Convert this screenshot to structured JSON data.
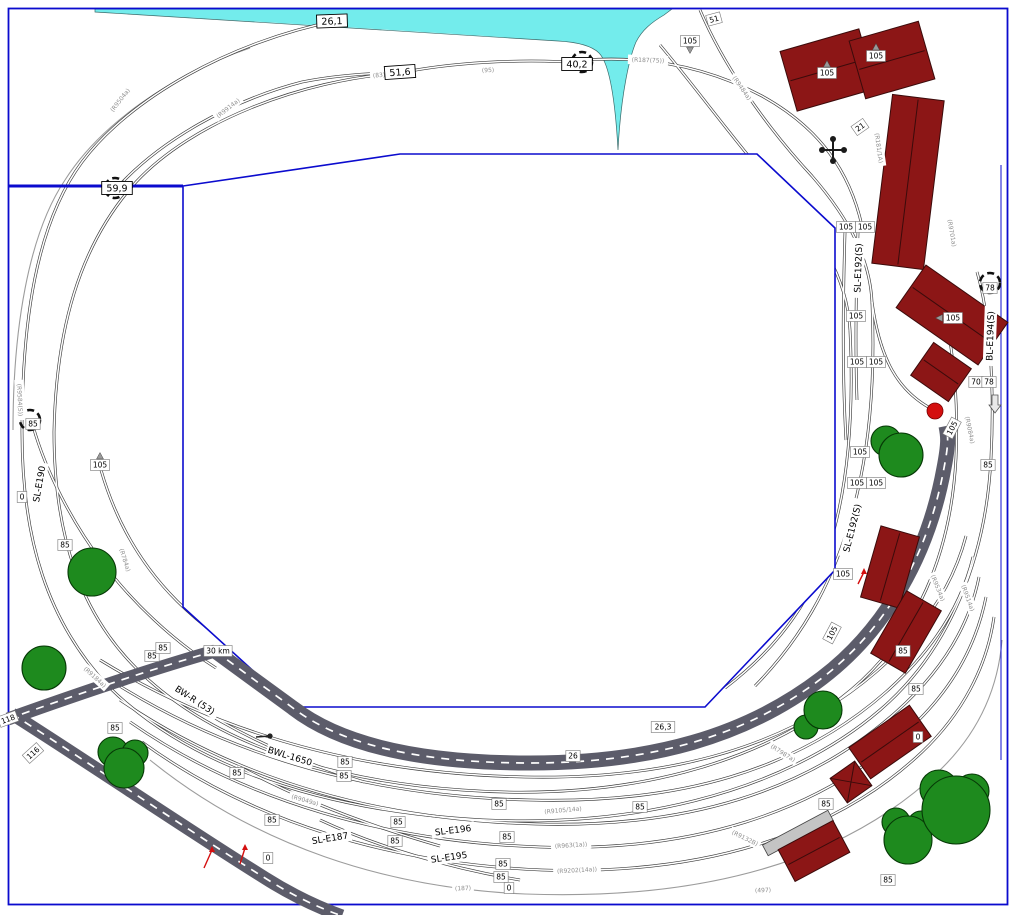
{
  "plan": {
    "colors": {
      "water": "#73ECEC",
      "boundary": "#0B0BCE",
      "building": "#8C1616",
      "building_edge": "#3B0B0B",
      "tree": "#1E8A1E",
      "tree_edge": "#063906",
      "road": "#5C5C6A",
      "road_dash": "#FFFFFF",
      "rail": "#3B3B3B",
      "rail_gap": "#FFFFFF",
      "rail_light": "#9C9C9C",
      "label_text": "#000000",
      "ref_text": "#8F8F8F",
      "signal_red": "#D40F0F",
      "platform": "#C4C4C4"
    },
    "measure_labels_large": [
      {
        "t": "26,1",
        "x": 332,
        "y": 21,
        "r": -2
      },
      {
        "t": "51,6",
        "x": 400,
        "y": 72,
        "r": -4
      },
      {
        "t": "40,2",
        "x": 577,
        "y": 64,
        "r": 0
      },
      {
        "t": "59,9",
        "x": 117,
        "y": 188,
        "r": 0
      }
    ],
    "measure_labels": [
      {
        "t": "85",
        "x": 33,
        "y": 424
      },
      {
        "t": "0",
        "x": 22,
        "y": 497
      },
      {
        "t": "105",
        "x": 100,
        "y": 465,
        "ptr": "up"
      },
      {
        "t": "85",
        "x": 65,
        "y": 545
      },
      {
        "t": "85",
        "x": 152,
        "y": 656
      },
      {
        "t": "85",
        "x": 163,
        "y": 648
      },
      {
        "t": "85",
        "x": 115,
        "y": 728
      },
      {
        "t": "118",
        "x": 8,
        "y": 719,
        "r": -20
      },
      {
        "t": "116",
        "x": 33,
        "y": 753,
        "r": -42
      },
      {
        "t": "30 km",
        "x": 218,
        "y": 651
      },
      {
        "t": "85",
        "x": 237,
        "y": 773
      },
      {
        "t": "85",
        "x": 272,
        "y": 820
      },
      {
        "t": "0",
        "x": 268,
        "y": 858
      },
      {
        "t": "85",
        "x": 345,
        "y": 762
      },
      {
        "t": "85",
        "x": 344,
        "y": 776
      },
      {
        "t": "85",
        "x": 398,
        "y": 822
      },
      {
        "t": "85",
        "x": 395,
        "y": 841
      },
      {
        "t": "85",
        "x": 499,
        "y": 804
      },
      {
        "t": "85",
        "x": 507,
        "y": 837
      },
      {
        "t": "85",
        "x": 503,
        "y": 864
      },
      {
        "t": "85",
        "x": 501,
        "y": 877
      },
      {
        "t": "0",
        "x": 509,
        "y": 888
      },
      {
        "t": "26",
        "x": 573,
        "y": 756
      },
      {
        "t": "26,3",
        "x": 663,
        "y": 727
      },
      {
        "t": "85",
        "x": 640,
        "y": 807
      },
      {
        "t": "85",
        "x": 826,
        "y": 804
      },
      {
        "t": "85",
        "x": 888,
        "y": 880
      },
      {
        "t": "85",
        "x": 903,
        "y": 651
      },
      {
        "t": "85",
        "x": 916,
        "y": 689
      },
      {
        "t": "0",
        "x": 918,
        "y": 737
      },
      {
        "t": "105",
        "x": 832,
        "y": 633,
        "r": -62
      },
      {
        "t": "105",
        "x": 843,
        "y": 574
      },
      {
        "t": "105",
        "x": 952,
        "y": 428,
        "r": -62
      },
      {
        "t": "105",
        "x": 846,
        "y": 227
      },
      {
        "t": "105",
        "x": 865,
        "y": 227
      },
      {
        "t": "105",
        "x": 856,
        "y": 316
      },
      {
        "t": "105",
        "x": 857,
        "y": 362
      },
      {
        "t": "105",
        "x": 876,
        "y": 362
      },
      {
        "t": "105",
        "x": 860,
        "y": 452
      },
      {
        "t": "105",
        "x": 857,
        "y": 483
      },
      {
        "t": "105",
        "x": 876,
        "y": 483
      },
      {
        "t": "78",
        "x": 990,
        "y": 288
      },
      {
        "t": "70",
        "x": 976,
        "y": 382
      },
      {
        "t": "78",
        "x": 989,
        "y": 382
      },
      {
        "t": "85",
        "x": 988,
        "y": 465
      },
      {
        "t": "105",
        "x": 690,
        "y": 41,
        "ptr": "down"
      },
      {
        "t": "105",
        "x": 827,
        "y": 73,
        "ptr": "up"
      },
      {
        "t": "105",
        "x": 876,
        "y": 56,
        "ptr": "up"
      },
      {
        "t": "105",
        "x": 953,
        "y": 318,
        "ptr": "left"
      },
      {
        "t": "21",
        "x": 860,
        "y": 127,
        "r": -35
      },
      {
        "t": "51",
        "x": 714,
        "y": 19,
        "r": -15
      }
    ],
    "ref_labels": [
      {
        "t": "(R9504a)",
        "x": 120,
        "y": 100,
        "r": -52
      },
      {
        "t": "(R9914a)",
        "x": 228,
        "y": 108,
        "r": -38
      },
      {
        "t": "(83)",
        "x": 379,
        "y": 75,
        "r": -4
      },
      {
        "t": "(95)",
        "x": 488,
        "y": 70,
        "r": -2
      },
      {
        "t": "(R187(75))",
        "x": 648,
        "y": 60,
        "r": 2
      },
      {
        "t": "(R9484a)",
        "x": 742,
        "y": 88,
        "r": 55
      },
      {
        "t": "(R181/1A)",
        "x": 879,
        "y": 148,
        "r": 82
      },
      {
        "t": "(R9701a)",
        "x": 952,
        "y": 233,
        "r": 80
      },
      {
        "t": "(R9534a)",
        "x": 938,
        "y": 588,
        "r": 68
      },
      {
        "t": "(R9514a)",
        "x": 968,
        "y": 598,
        "r": 70
      },
      {
        "t": "(R9084a)",
        "x": 970,
        "y": 430,
        "r": 78
      },
      {
        "t": "(R784a)",
        "x": 125,
        "y": 560,
        "r": 72
      },
      {
        "t": "(R9584(S))",
        "x": 20,
        "y": 400,
        "r": 87
      },
      {
        "t": "(R9184a)",
        "x": 95,
        "y": 677,
        "r": 42
      },
      {
        "t": "(R9049a)",
        "x": 305,
        "y": 800,
        "r": 16
      },
      {
        "t": "(R9105/14a)",
        "x": 563,
        "y": 810,
        "r": -5
      },
      {
        "t": "(R963(1a))",
        "x": 571,
        "y": 845,
        "r": -4
      },
      {
        "t": "(R9202(14a))",
        "x": 577,
        "y": 870,
        "r": -3
      },
      {
        "t": "(187)",
        "x": 463,
        "y": 888,
        "r": -2
      },
      {
        "t": "(497)",
        "x": 763,
        "y": 890,
        "r": -2
      },
      {
        "t": "(R9132B)",
        "x": 745,
        "y": 838,
        "r": 26
      },
      {
        "t": "(R7987a)",
        "x": 783,
        "y": 753,
        "r": 32
      }
    ],
    "track_names": [
      {
        "t": "SL-E187",
        "x": 330,
        "y": 838,
        "r": -9
      },
      {
        "t": "SL-E196",
        "x": 453,
        "y": 830,
        "r": -7
      },
      {
        "t": "SL-E195",
        "x": 449,
        "y": 857,
        "r": -8
      },
      {
        "t": "BWL-1650",
        "x": 290,
        "y": 756,
        "r": 17
      },
      {
        "t": "BW-R (53)",
        "x": 195,
        "y": 700,
        "r": 33
      },
      {
        "t": "SL-E192(S)",
        "x": 858,
        "y": 268,
        "r": -88
      },
      {
        "t": "SL-E192(S)",
        "x": 852,
        "y": 528,
        "r": -76
      },
      {
        "t": "BL-E194(S)",
        "x": 990,
        "y": 336,
        "r": -88
      },
      {
        "t": "SL-E190",
        "x": 39,
        "y": 484,
        "r": -80
      }
    ],
    "buildings": [
      {
        "x": 828,
        "y": 70,
        "w": 82,
        "h": 62,
        "r": -16
      },
      {
        "x": 892,
        "y": 60,
        "w": 72,
        "h": 60,
        "r": -16
      },
      {
        "x": 908,
        "y": 182,
        "w": 52,
        "h": 170,
        "r": 7
      },
      {
        "x": 952,
        "y": 315,
        "w": 100,
        "h": 52,
        "r": 35
      },
      {
        "x": 941,
        "y": 372,
        "w": 46,
        "h": 40,
        "r": 35
      },
      {
        "x": 890,
        "y": 567,
        "w": 40,
        "h": 74,
        "r": 16
      },
      {
        "x": 906,
        "y": 632,
        "w": 40,
        "h": 72,
        "r": 30
      },
      {
        "x": 890,
        "y": 742,
        "w": 74,
        "h": 38,
        "r": -35
      },
      {
        "x": 851,
        "y": 782,
        "w": 30,
        "h": 30,
        "r": -35,
        "cross": true
      },
      {
        "x": 814,
        "y": 851,
        "w": 62,
        "h": 36,
        "r": -28
      }
    ],
    "platform": {
      "x": 798,
      "y": 833,
      "w": 74,
      "h": 12,
      "r": -28
    },
    "trees": [
      {
        "c": [
          [
            92,
            572,
            24
          ]
        ]
      },
      {
        "c": [
          [
            44,
            668,
            22
          ]
        ]
      },
      {
        "c": [
          [
            113,
            752,
            15
          ],
          [
            135,
            753,
            13
          ],
          [
            124,
            768,
            20
          ]
        ]
      },
      {
        "c": [
          [
            806,
            727,
            12
          ],
          [
            823,
            710,
            19
          ]
        ]
      },
      {
        "c": [
          [
            886,
            441,
            15
          ],
          [
            901,
            455,
            22
          ]
        ]
      },
      {
        "c": [
          [
            896,
            822,
            14
          ],
          [
            921,
            824,
            13
          ],
          [
            908,
            840,
            24
          ]
        ]
      },
      {
        "c": [
          [
            939,
            789,
            19
          ],
          [
            972,
            791,
            17
          ],
          [
            956,
            810,
            34
          ]
        ]
      }
    ],
    "portals": [
      {
        "x": 582,
        "y": 62
      },
      {
        "x": 115,
        "y": 188
      },
      {
        "x": 30,
        "y": 420
      },
      {
        "x": 990,
        "y": 283
      }
    ],
    "signals": {
      "red_dot": {
        "x": 935,
        "y": 411,
        "r": 8
      },
      "red_arrows": [
        {
          "x1": 204,
          "y1": 868,
          "x2": 212,
          "y2": 850
        },
        {
          "x1": 240,
          "y1": 864,
          "x2": 245,
          "y2": 848
        },
        {
          "x1": 858,
          "y1": 584,
          "x2": 864,
          "y2": 572
        }
      ],
      "black_marker": {
        "x": 270,
        "y": 736
      },
      "cross_marker": {
        "x": 833,
        "y": 150
      },
      "gradient_arrow": {
        "x": 995,
        "y": 403
      }
    }
  }
}
